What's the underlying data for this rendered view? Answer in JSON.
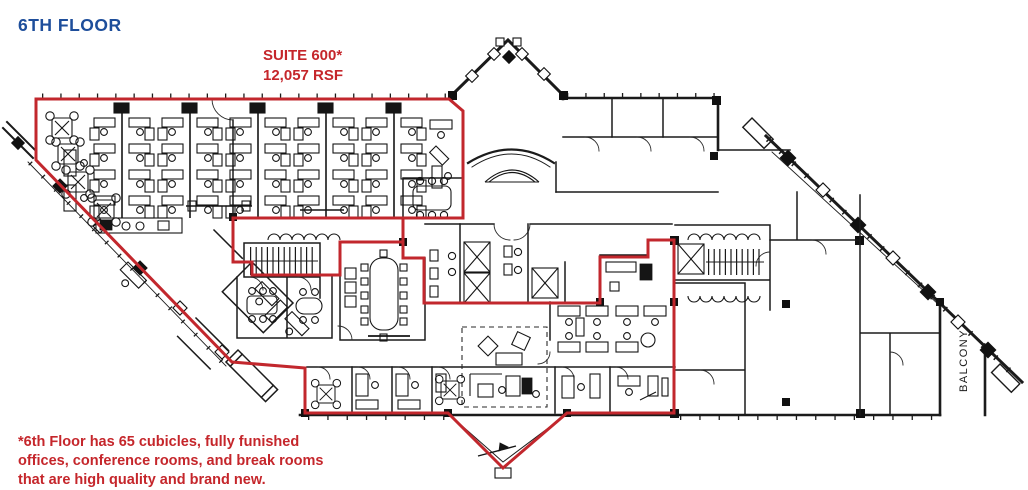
{
  "title": "6TH FLOOR",
  "suite_label": {
    "line1": "SUITE 600*",
    "line2": "12,057 RSF"
  },
  "footnote": {
    "line1": "*6th Floor has 65 cubicles, fully funished",
    "line2": "offices, conference rooms, and break rooms",
    "line3": "that are high quality and brand new."
  },
  "balcony_label": "BALCONY",
  "colors": {
    "title_blue": "#1e4e9b",
    "suite_red": "#c5262b",
    "outline_red": "#c2272d",
    "wall_black": "#1b1b1b"
  }
}
